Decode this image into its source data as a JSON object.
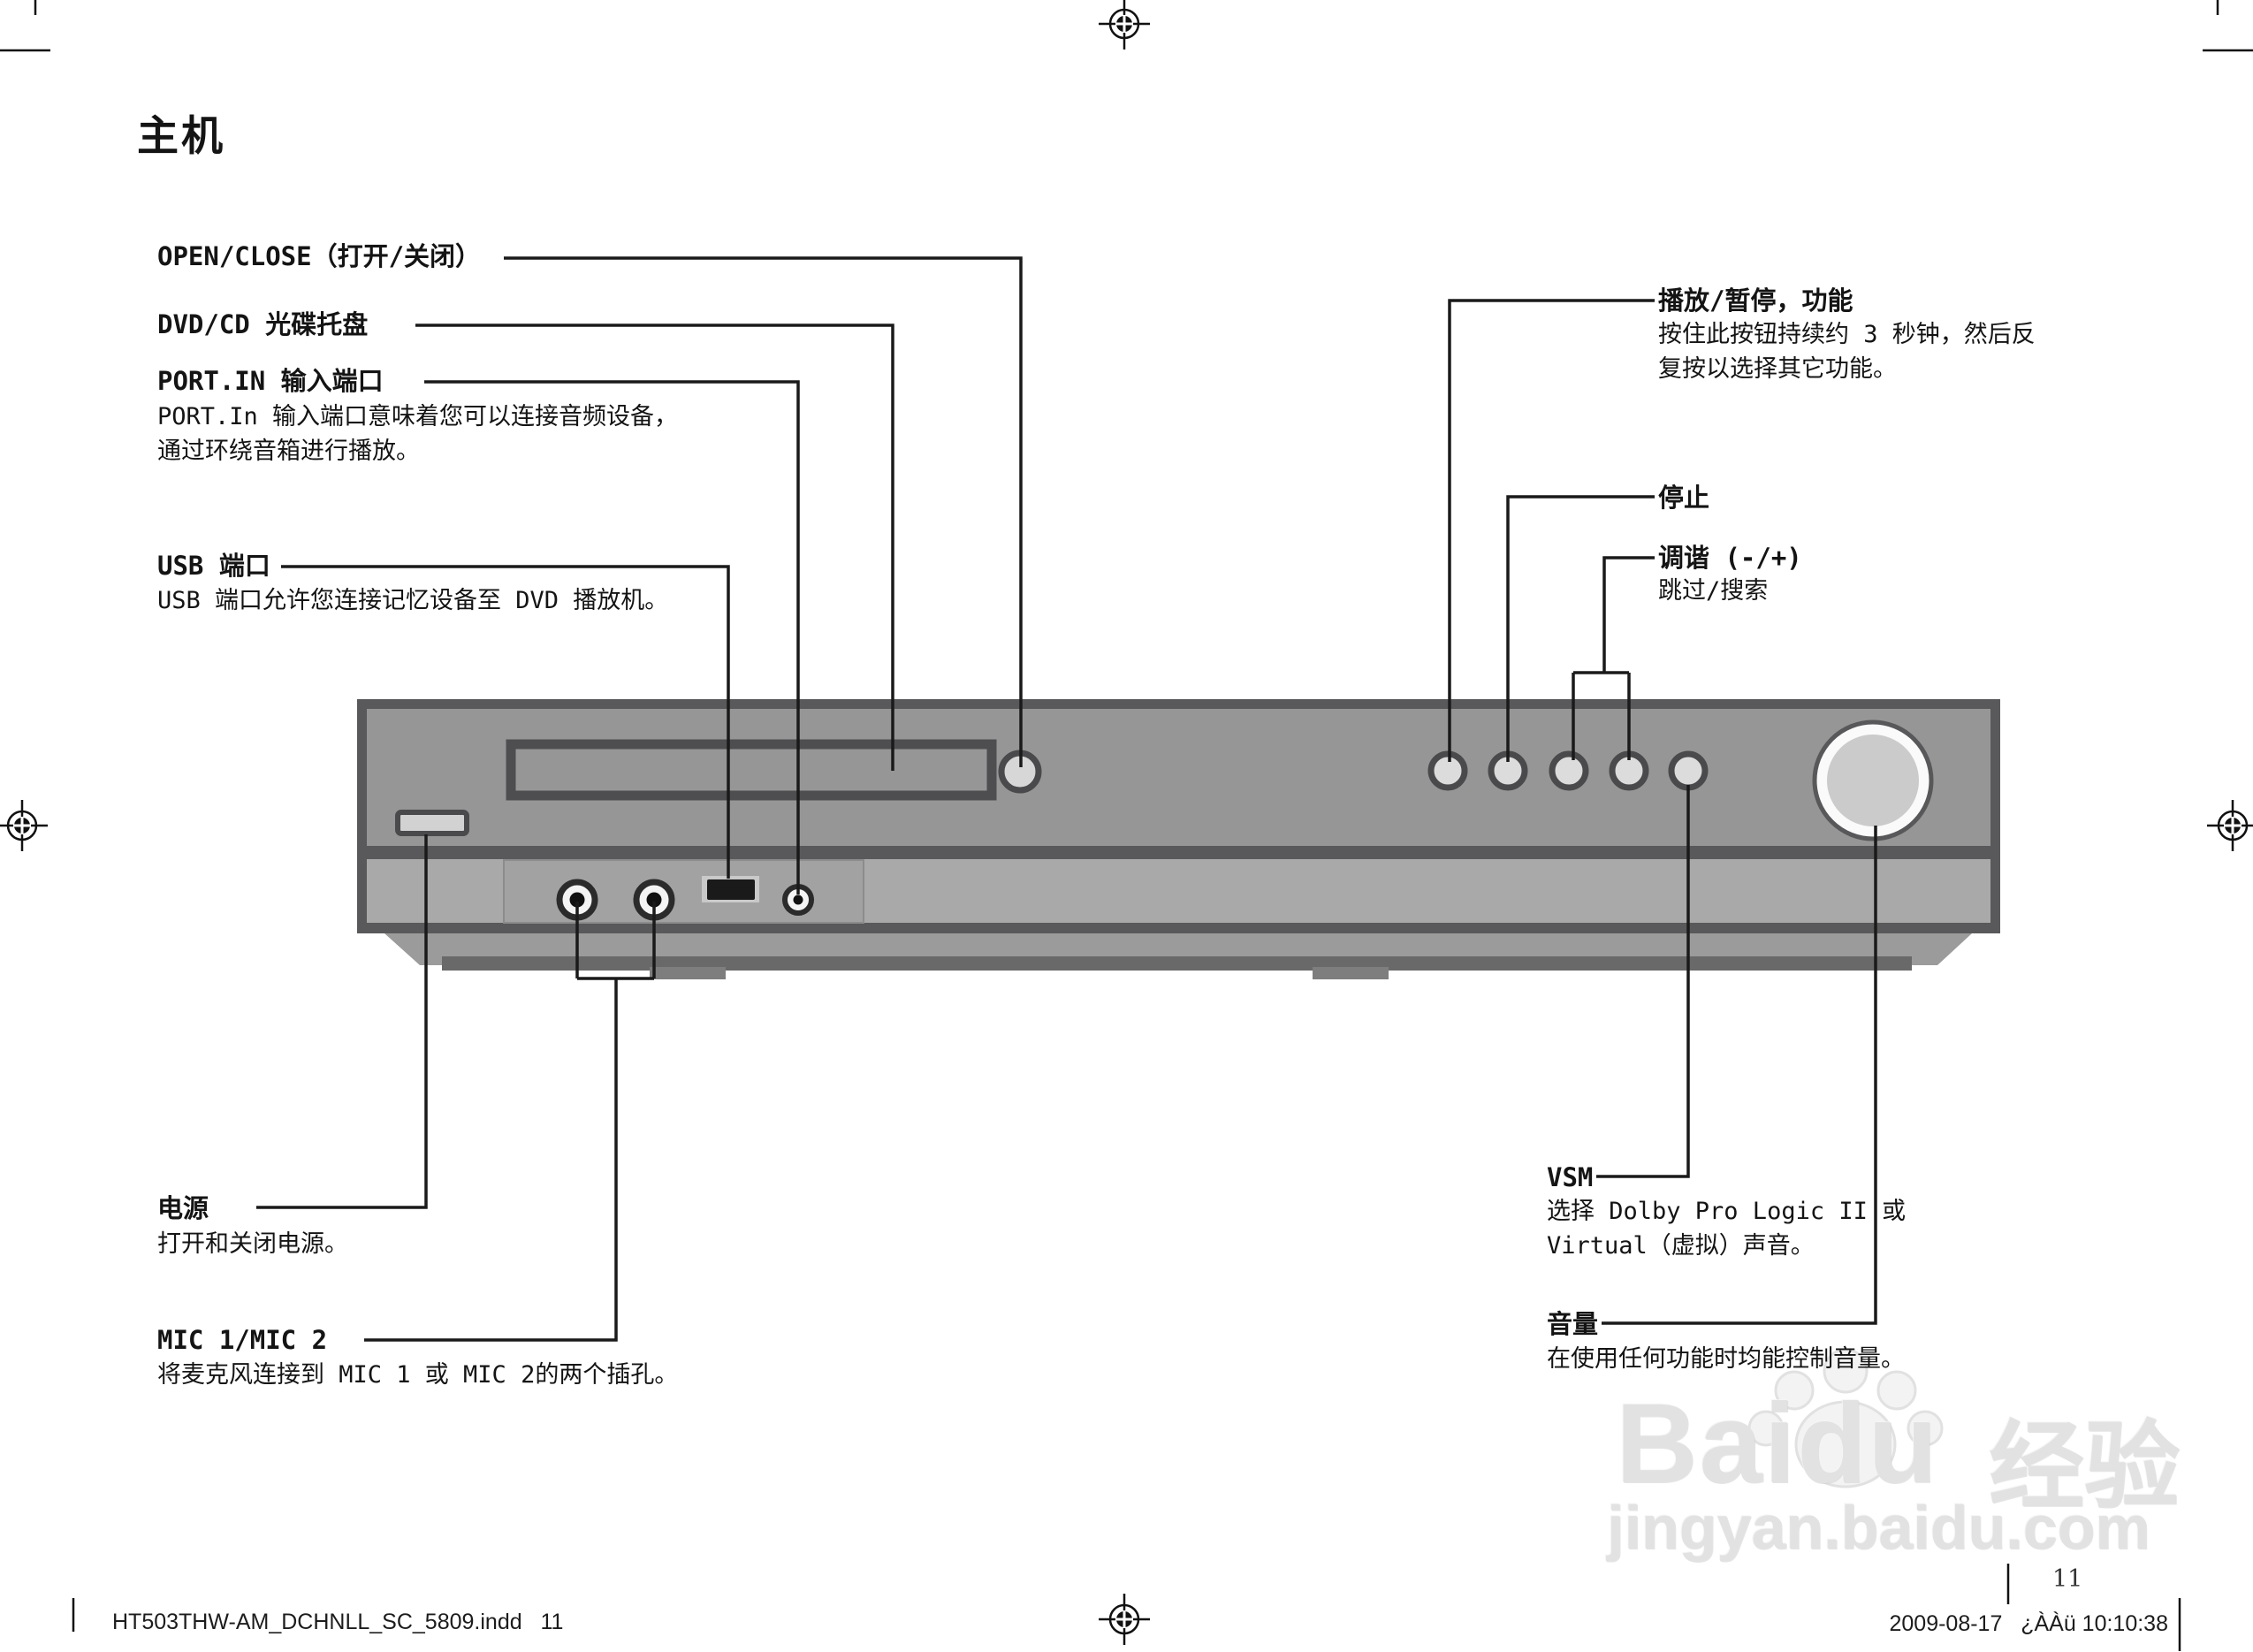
{
  "page": {
    "title": "主机",
    "page_number": "11"
  },
  "callouts": {
    "open_close": {
      "label": "OPEN/CLOSE（打开/关闭）"
    },
    "tray": {
      "label": "DVD/CD 光碟托盘"
    },
    "port_in": {
      "label": "PORT.IN 输入端口",
      "desc1": "PORT.In 输入端口意味着您可以连接音频设备，",
      "desc2": "通过环绕音箱进行播放。"
    },
    "usb": {
      "label": "USB 端口",
      "desc": "USB 端口允许您连接记忆设备至 DVD 播放机。"
    },
    "play_pause": {
      "label": "播放/暂停，功能",
      "desc1": "按住此按钮持续约 3 秒钟，然后反",
      "desc2": "复按以选择其它功能。"
    },
    "stop": {
      "label": "停止"
    },
    "tuning": {
      "label": "调谐 (-/+)",
      "desc": "跳过/搜索"
    },
    "power": {
      "label": "电源",
      "desc": "打开和关闭电源。"
    },
    "mic": {
      "label": "MIC 1/MIC 2",
      "desc": "将麦克风连接到 MIC 1 或 MIC 2的两个插孔。"
    },
    "vsm": {
      "label": "VSM",
      "desc1": "选择 Dolby Pro Logic II 或",
      "desc2": "Virtual（虚拟）声音。"
    },
    "volume": {
      "label": "音量",
      "desc": "在使用任何功能时均能控制音量。"
    }
  },
  "watermark": {
    "brand": "Baidu",
    "brand_cn": "经验",
    "domain": "jingyan.baidu.com"
  },
  "footer": {
    "left": "HT503THW-AM_DCHNLL_SC_5809.indd   11",
    "right": "2009-08-17   ¿ÀÀü 10:10:38"
  },
  "colors": {
    "device_frame": "#59595b",
    "device_body": "#969696",
    "device_strip": "#a9a9a9",
    "button_fill": "#dcdcdc",
    "jack_fill": "#f4f4f4",
    "line": "#1a1a1a",
    "watermark_gray": "#e2e2e2"
  }
}
